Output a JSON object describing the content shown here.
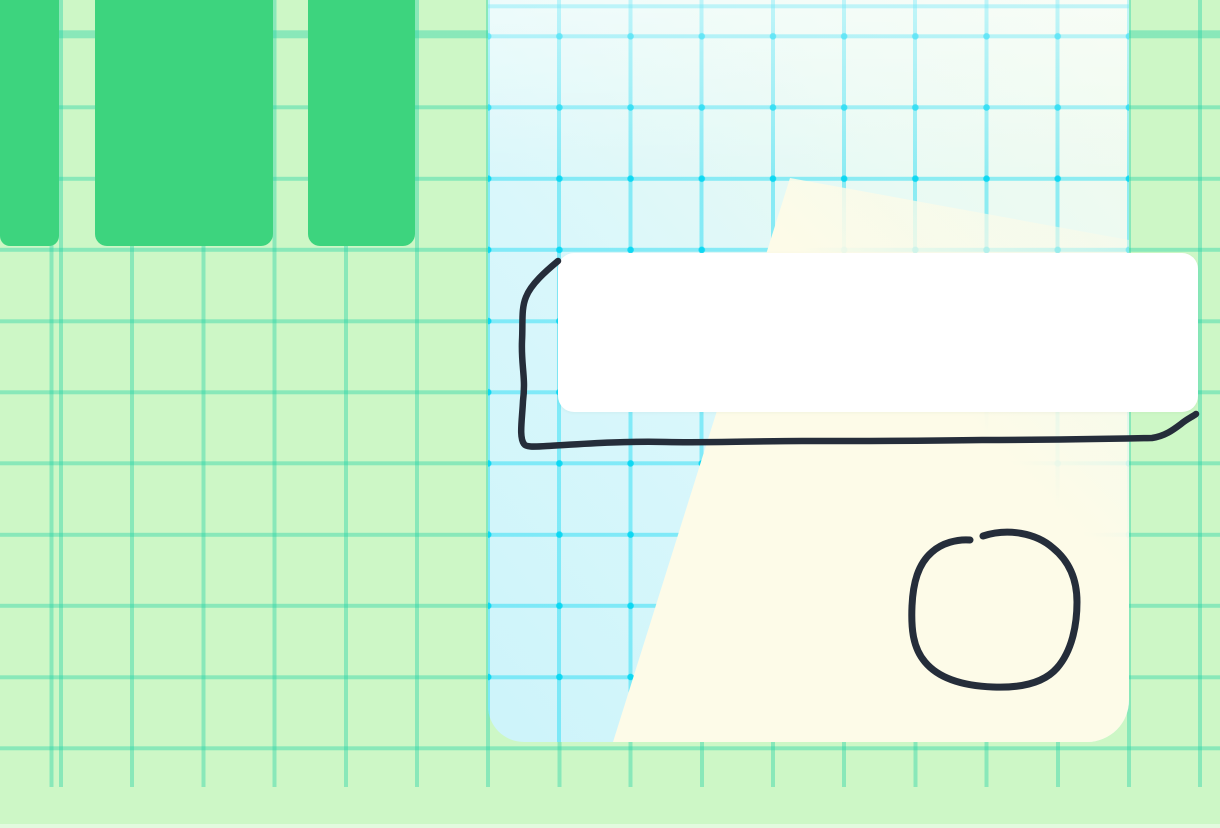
{
  "app": {
    "name": "whiteboard-canvas",
    "visible_text": "none"
  },
  "css_vars": {
    "canvas_bg": "#cdf7c6",
    "grid_green": "rgba(27,209,163,0.38)",
    "grid_size": "71.2px",
    "grid_off_x": "59px",
    "grid_off_y": "34.3px",
    "bar_green": "#3dd47e",
    "panel_cyan_deep": "#cdf4fa",
    "panel_cyan": "#d9f7fb",
    "panel_mint": "#eafaf3",
    "panel_mint_pale": "#f2fbee",
    "panel_cream": "#fdfbe8",
    "panel_line": "rgba(0,214,242,0.40)",
    "panel_dot": "rgba(0,214,242,0.85)",
    "card_bg": "#ffffff",
    "ink": "#252d3a"
  },
  "objects": [
    {
      "id": "column-1",
      "type": "rect",
      "x": 0,
      "y": 0,
      "w": 59,
      "h": 246,
      "fill": "bar_green",
      "radius": "0 0 10px 10px"
    },
    {
      "id": "column-2",
      "type": "rect",
      "x": 95,
      "y": 0,
      "w": 178,
      "h": 246,
      "fill": "bar_green",
      "radius": "0 0 12px 12px"
    },
    {
      "id": "column-3",
      "type": "rect",
      "x": 308,
      "y": 0,
      "w": 107,
      "h": 246,
      "fill": "bar_green",
      "radius": "0 0 12px 12px"
    },
    {
      "id": "panel",
      "type": "panel",
      "x": 488,
      "y": 0,
      "w": 641,
      "h": 742,
      "radius": "0 0 42px 36px"
    },
    {
      "id": "card",
      "type": "rect",
      "x": 558,
      "y": 253,
      "w": 640,
      "h": 159,
      "fill": "card_bg",
      "radius": "16px"
    }
  ],
  "ink": {
    "box": {
      "description": "hand-drawn open box / underline stroke hugging left and bottom of white card",
      "path": "M 558 261 C 546 271 531 284 526 297 C 521 309 523 323 522 341 C 521 366 526 377 523 401 C 522 421 519 437 524 444 C 526 447 532 447 547 446 C 582 444 622 441 666 442 C 712 443 752 441 802 441 C 862 441 922 441 982 440 C 1042 440 1102 439 1152 438 C 1165 436 1173 430 1181 424 C 1187 419 1192 417 1196 414"
    },
    "circle": {
      "description": "hand-drawn circle with small gap at top-left",
      "path": "M 983 536 C 1008 528 1036 533 1053 548 C 1069 561 1077 579 1077 602 C 1077 625 1072 651 1057 668 C 1043 684 1018 688 993 687 C 967 686 940 680 925 662 C 913 648 911 629 912 606 C 913 583 918 564 932 552 C 942 543 957 539 970 540"
    }
  }
}
